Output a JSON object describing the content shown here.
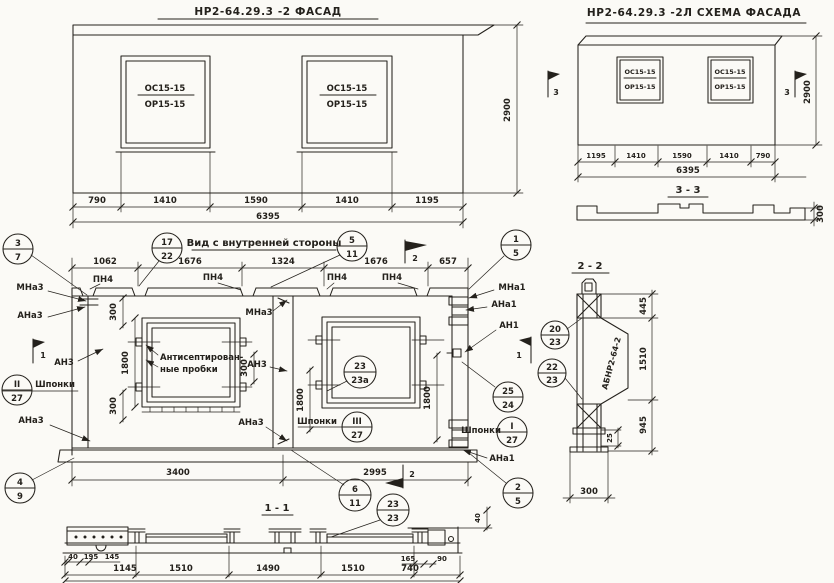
{
  "win": {
    "top": "ОС15-15",
    "bottom": "ОР15-15"
  },
  "facade": {
    "title": "НР2-64.29.3 -2  ФАСАД",
    "dims": [
      "790",
      "1410",
      "1590",
      "1410",
      "1195"
    ],
    "total": "6395",
    "height": "2900"
  },
  "scheme": {
    "title": "НР2-64.29.3 -2Л  СХЕМА ФАСАДА",
    "dims": [
      "1195",
      "1410",
      "1590",
      "1410",
      "790"
    ],
    "total": "6395",
    "height": "2900",
    "mark": "3"
  },
  "section33": {
    "title": "3 - 3",
    "depth": "300"
  },
  "inner": {
    "title": "Вид с внутренней стороны",
    "dims_top": [
      "1062",
      "1676",
      "1324",
      "1676",
      "657"
    ],
    "dim_3400": "3400",
    "dim_2995": "2995",
    "dim_1800": "1800",
    "dim_300": "300",
    "mark1": "1",
    "mark2": "2",
    "lbl": {
      "pn4": "ПН4",
      "mna3": "МНа3",
      "ana3": "АНа3",
      "an3": "АН3",
      "mna1": "МНа1",
      "ana1": "АНа1",
      "an1": "АН1",
      "shponki": "Шпонки",
      "plugs1": "Антисептирован-",
      "plugs2": "ные пробки"
    },
    "co": {
      "c37": {
        "t": "3",
        "b": "7"
      },
      "c1722": {
        "t": "17",
        "b": "22"
      },
      "c511": {
        "t": "5",
        "b": "11"
      },
      "c15": {
        "t": "1",
        "b": "5"
      },
      "c227": {
        "t": "II",
        "b": "27"
      },
      "c49": {
        "t": "4",
        "b": "9"
      },
      "c327": {
        "t": "III",
        "b": "27"
      },
      "c2323a": {
        "t": "23",
        "b": "23а"
      },
      "c2524": {
        "t": "25",
        "b": "24"
      },
      "c127": {
        "t": "I",
        "b": "27"
      },
      "c611": {
        "t": "6",
        "b": "11"
      },
      "c25": {
        "t": "2",
        "b": "5"
      },
      "c2323": {
        "t": "23",
        "b": "23"
      }
    }
  },
  "section22": {
    "title": "2 - 2",
    "part": "АБНР2-64-2",
    "d445": "445",
    "d1510": "1510",
    "d945": "945",
    "d25": "25",
    "d300": "300",
    "co": {
      "c2023": {
        "t": "20",
        "b": "23"
      },
      "c2223": {
        "t": "22",
        "b": "23"
      }
    }
  },
  "section11": {
    "title": "1 - 1",
    "small": [
      "40",
      "195",
      "145"
    ],
    "dims": [
      "1145",
      "1510",
      "1490",
      "1510",
      "740"
    ],
    "d165": "165",
    "d90": "90",
    "d40": "40"
  }
}
